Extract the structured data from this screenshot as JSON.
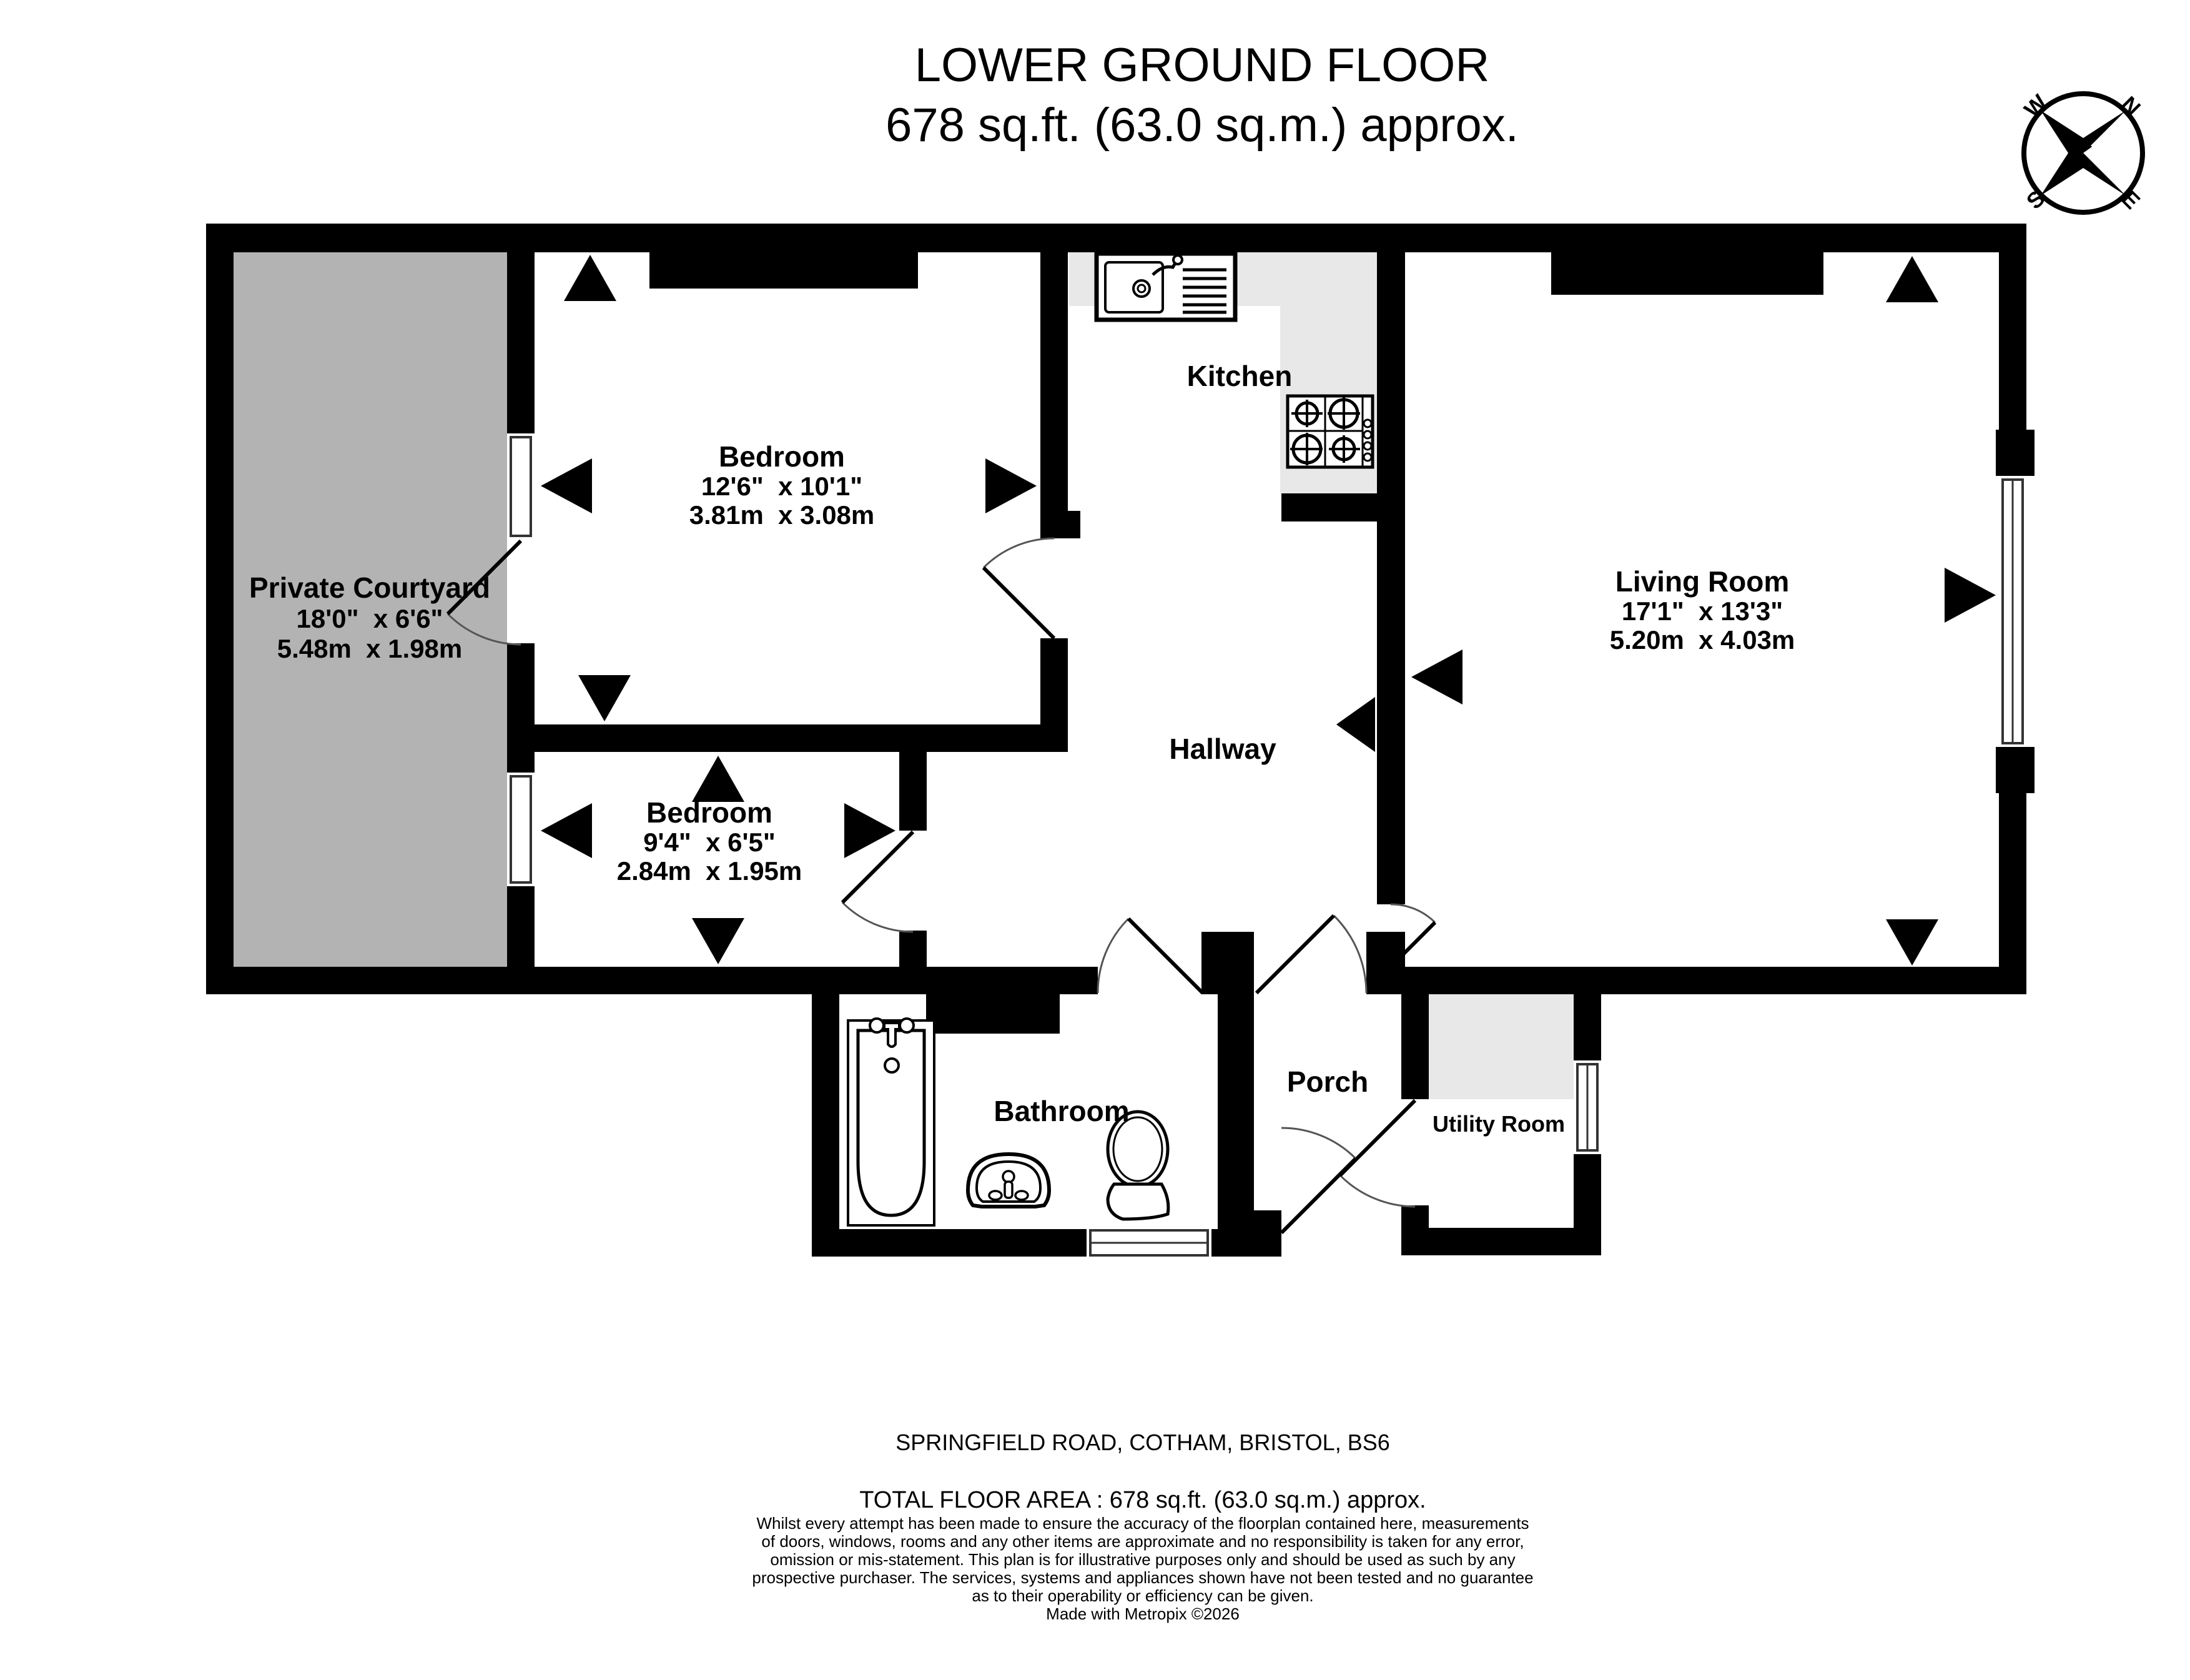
{
  "title": {
    "line1": "LOWER GROUND FLOOR",
    "line2": "678 sq.ft. (63.0 sq.m.) approx."
  },
  "compass": {
    "n": "N",
    "e": "E",
    "s": "S",
    "w": "W"
  },
  "rooms": {
    "courtyard": {
      "name": "Private Courtyard",
      "imperial": "18'0\"  x 6'6\"",
      "metric": "5.48m  x 1.98m"
    },
    "bedroom1": {
      "name": "Bedroom",
      "imperial": "12'6\"  x 10'1\"",
      "metric": "3.81m  x 3.08m"
    },
    "bedroom2": {
      "name": "Bedroom",
      "imperial": "9'4\"  x 6'5\"",
      "metric": "2.84m  x 1.95m"
    },
    "living": {
      "name": "Living Room",
      "imperial": "17'1\"  x 13'3\"",
      "metric": "5.20m  x 4.03m"
    },
    "kitchen": {
      "name": "Kitchen"
    },
    "hallway": {
      "name": "Hallway"
    },
    "bathroom": {
      "name": "Bathroom"
    },
    "porch": {
      "name": "Porch"
    },
    "utility": {
      "name": "Utility Room"
    }
  },
  "footer": {
    "address": "SPRINGFIELD ROAD, COTHAM, BRISTOL, BS6",
    "total_area": "TOTAL FLOOR AREA : 678 sq.ft. (63.0 sq.m.) approx.",
    "disclaimer_lines": [
      "Whilst every attempt has been made to ensure the accuracy of the floorplan contained here, measurements",
      "of doors, windows, rooms and any other items are approximate and no responsibility is taken for any error,",
      "omission or mis-statement. This plan is for illustrative purposes only and should be used as such by any",
      "prospective purchaser. The services, systems and appliances shown have not been tested and no guarantee",
      "as to their operability or efficiency can be given."
    ],
    "credit": "Made with Metropix ©2026"
  },
  "colors": {
    "wall": "#000000",
    "courtyard_fill": "#b3b3b3",
    "counter_fill": "#e8e8e8",
    "background": "#ffffff"
  }
}
